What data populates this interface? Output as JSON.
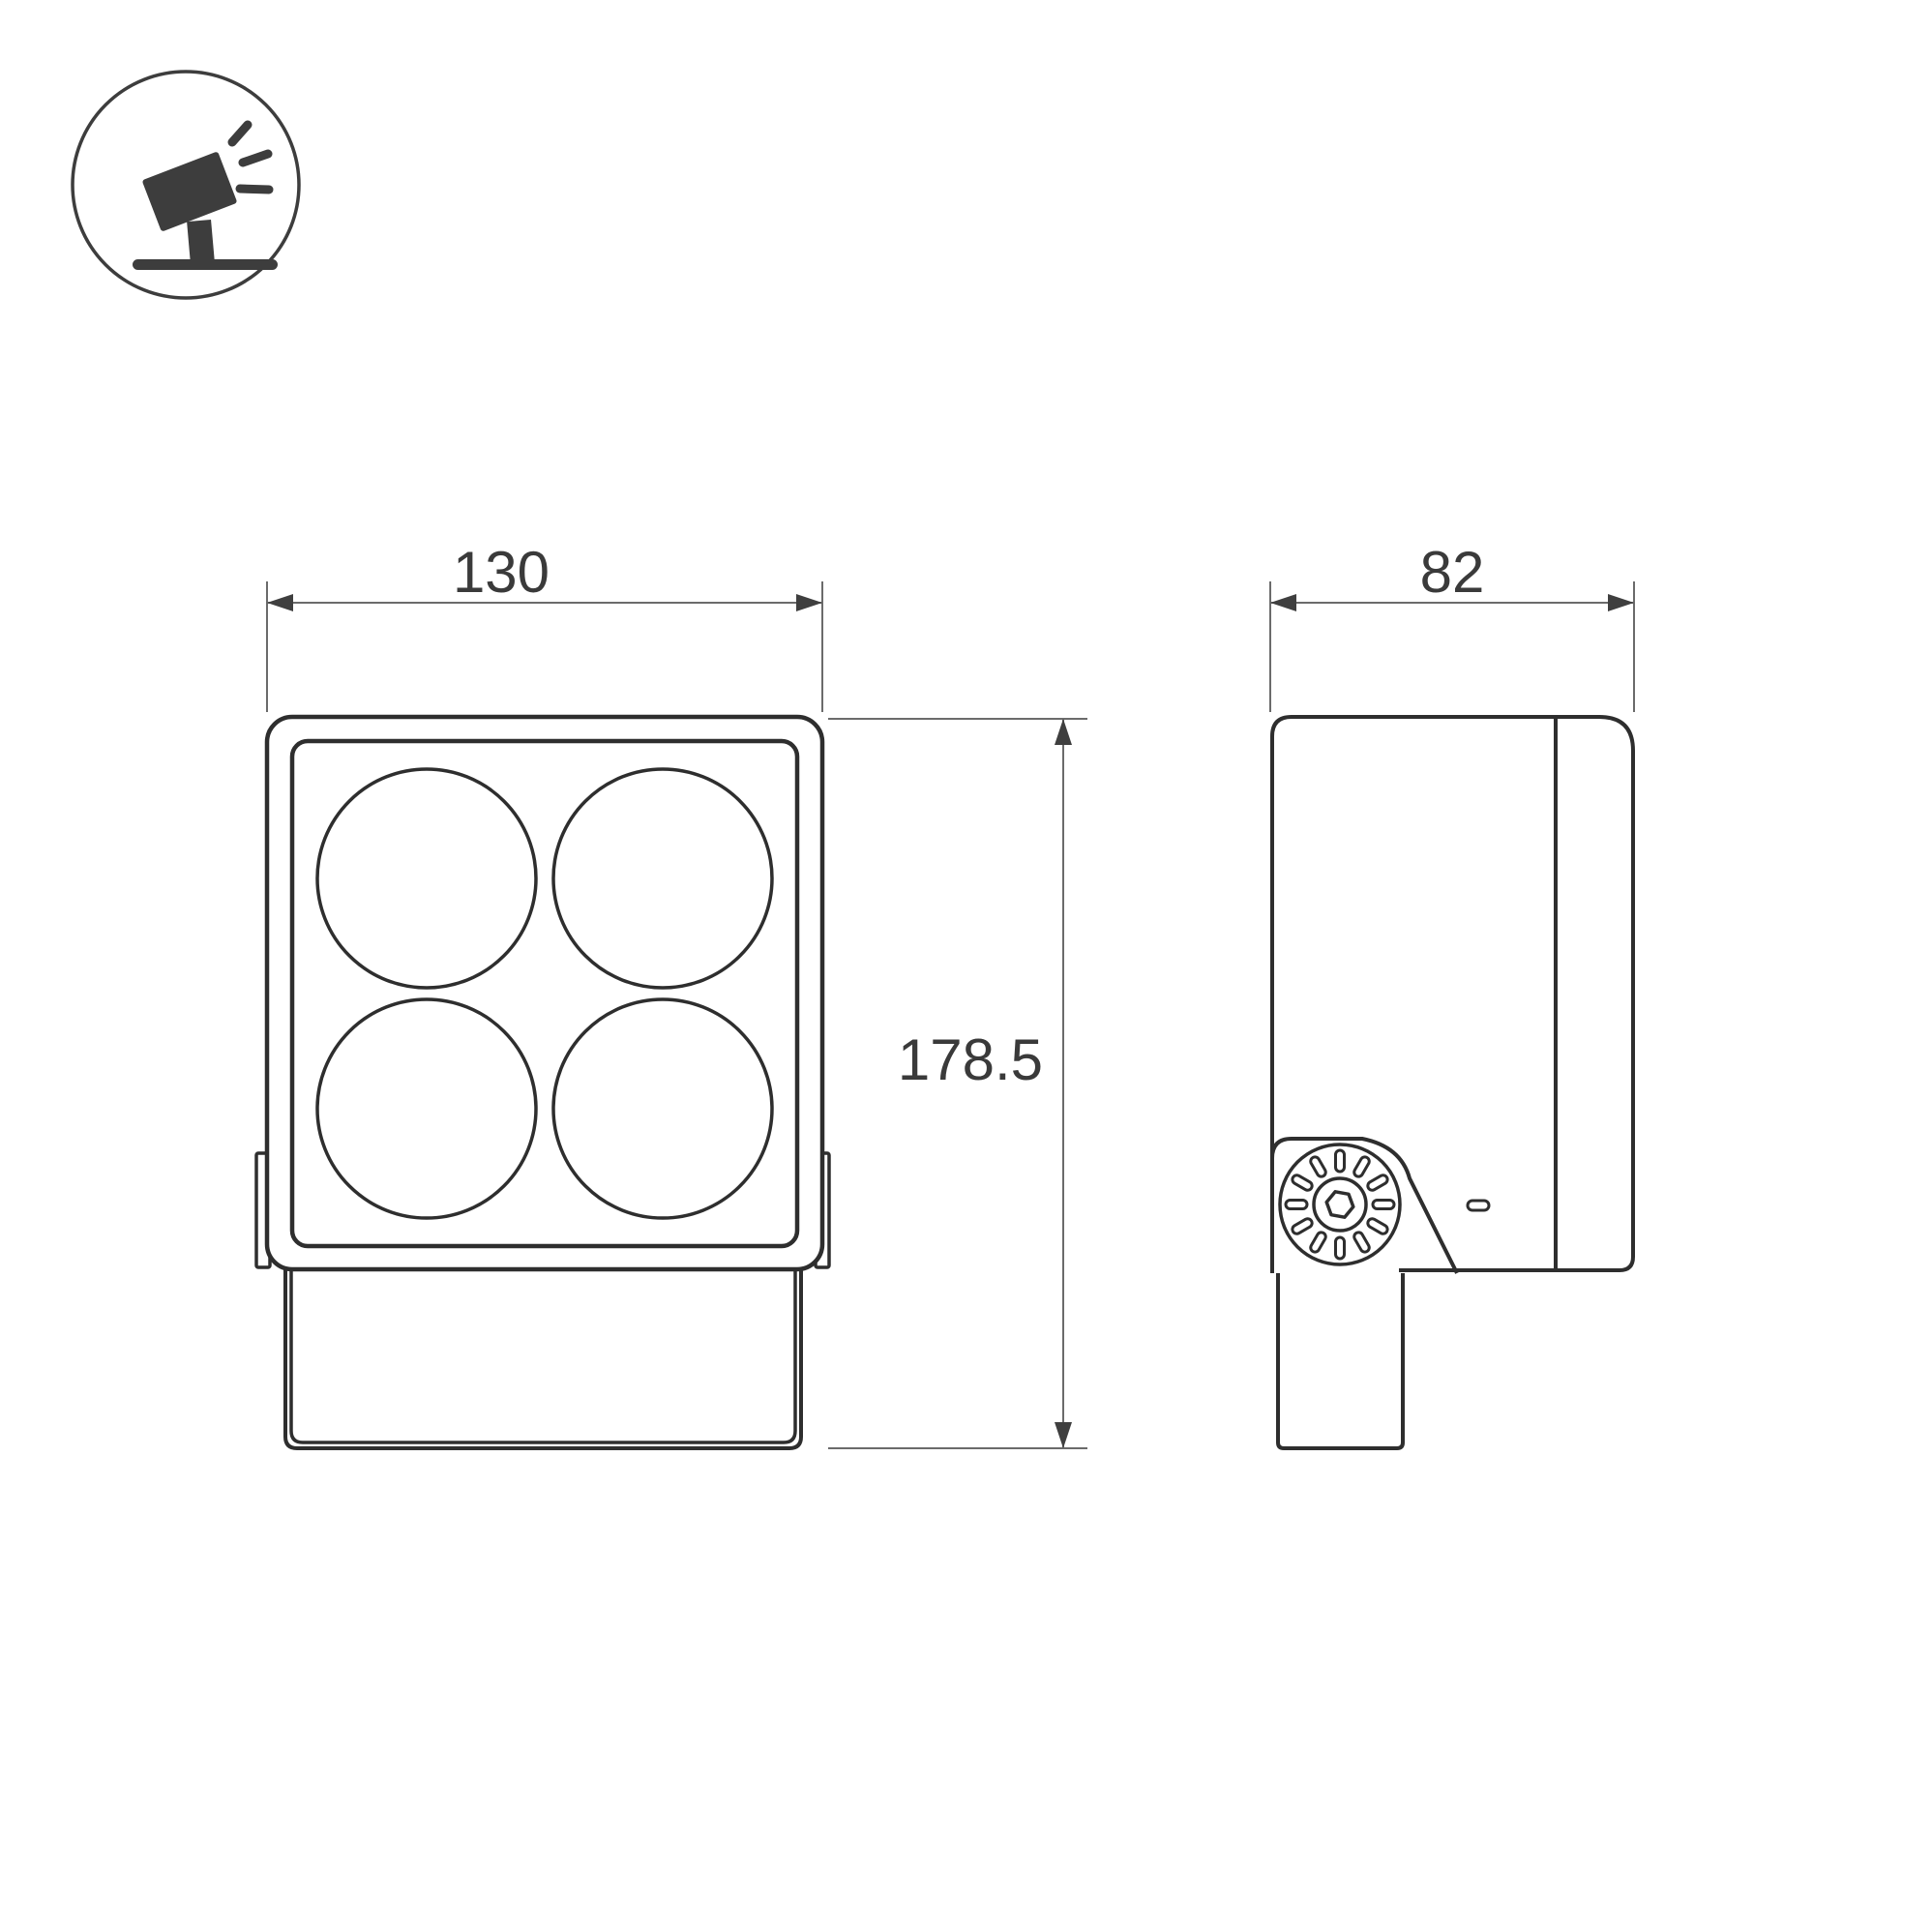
{
  "drawing": {
    "type_icon": "tilted-floodlight-on-ground-icon",
    "dimensions": {
      "front_width": "130",
      "overall_height": "178.5",
      "side_depth": "82"
    },
    "views": {
      "front": {
        "lens_count": 4
      },
      "side": {
        "knob_slot_count": 12
      }
    },
    "colors": {
      "background": "#ffffff",
      "object_line": "#2e2e2e",
      "dimension_line": "#6b6b6b",
      "arrow_fill": "#3f3f3f",
      "text": "#3a3a3a",
      "icon": "#3d3d3d"
    }
  }
}
